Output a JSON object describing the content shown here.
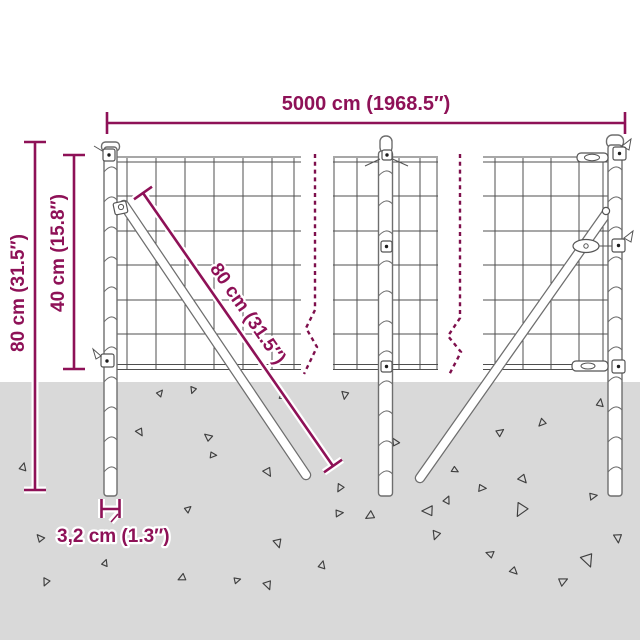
{
  "colors": {
    "accent": "#8E1157",
    "break_line": "#7E0F4C",
    "ground": "#D9D9D9",
    "fence_line": "#4F4F4F",
    "post_outline": "#6E6E6E",
    "triangle": "#3F3F3F"
  },
  "labels": {
    "total_width": "5000 cm (1968.5″)",
    "total_height": "80 cm (31.5″)",
    "above_ground_height": "40 cm (15.8″)",
    "brace_length": "80 cm (31.5″)",
    "post_width": "3,2 cm (1.3″)"
  },
  "decorations": {
    "ground_triangles": [
      [
        23,
        467,
        7,
        15
      ],
      [
        46,
        582,
        7,
        205
      ],
      [
        105,
        563,
        6,
        20
      ],
      [
        40,
        538,
        7,
        320
      ],
      [
        140,
        432,
        7,
        150
      ],
      [
        160,
        393,
        6,
        40
      ],
      [
        193,
        390,
        6,
        200
      ],
      [
        208,
        437,
        7,
        310
      ],
      [
        213,
        455,
        6,
        95
      ],
      [
        268,
        472,
        8,
        150
      ],
      [
        268,
        585,
        8,
        160
      ],
      [
        182,
        578,
        7,
        245
      ],
      [
        237,
        580,
        6,
        75
      ],
      [
        188,
        509,
        6,
        50
      ],
      [
        278,
        543,
        8,
        165
      ],
      [
        282,
        396,
        6,
        0
      ],
      [
        339,
        513,
        7,
        85
      ],
      [
        345,
        395,
        7,
        190
      ],
      [
        340,
        488,
        7,
        210
      ],
      [
        370,
        516,
        8,
        240
      ],
      [
        395,
        442,
        7,
        330
      ],
      [
        447,
        500,
        7,
        25
      ],
      [
        436,
        535,
        8,
        200
      ],
      [
        455,
        470,
        6,
        120
      ],
      [
        482,
        488,
        7,
        95
      ],
      [
        500,
        432,
        7,
        55
      ],
      [
        514,
        571,
        7,
        135
      ],
      [
        521,
        510,
        12,
        210
      ],
      [
        523,
        479,
        8,
        140
      ],
      [
        542,
        423,
        7,
        225
      ],
      [
        563,
        581,
        8,
        65
      ],
      [
        588,
        560,
        12,
        160
      ],
      [
        593,
        496,
        7,
        80
      ],
      [
        600,
        403,
        7,
        10
      ],
      [
        618,
        538,
        8,
        175
      ],
      [
        490,
        554,
        7,
        290
      ],
      [
        428,
        511,
        10,
        270
      ],
      [
        322,
        565,
        7,
        15
      ]
    ],
    "post_spirals": [
      {
        "x": 104,
        "w": 13,
        "top": 172,
        "bot": 486
      },
      {
        "x": 378.5,
        "w": 14,
        "top": 176,
        "bot": 486
      },
      {
        "x": 608,
        "w": 14,
        "top": 172,
        "bot": 486
      }
    ]
  }
}
